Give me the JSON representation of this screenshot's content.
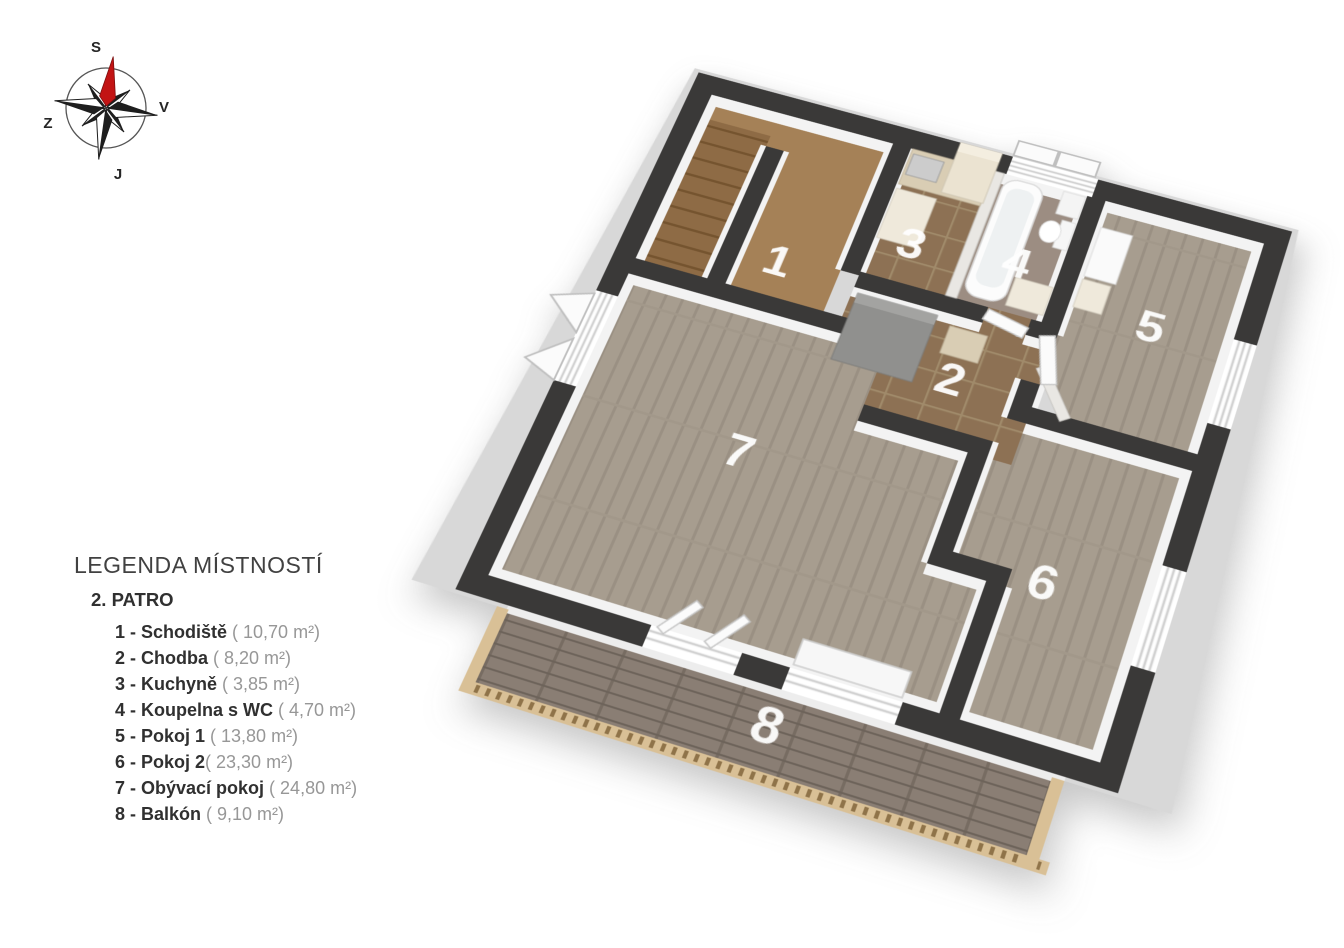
{
  "compass": {
    "north_label": "S",
    "east_label": "V",
    "south_label": "J",
    "west_label": "Z"
  },
  "legend": {
    "title": "LEGENDA MÍSTNOSTÍ",
    "floor": "2. PATRO",
    "items": [
      {
        "label": "1 - Schodiště",
        "area": " ( 10,70 m²)"
      },
      {
        "label": "2 - Chodba",
        "area": " ( 8,20 m²)"
      },
      {
        "label": "3 - Kuchyně",
        "area": " ( 3,85 m²)"
      },
      {
        "label": "4 - Koupelna s WC",
        "area": " ( 4,70 m²)"
      },
      {
        "label": "5 - Pokoj 1",
        "area": " ( 13,80 m²)"
      },
      {
        "label": "6 - Pokoj 2",
        "area": "( 23,30 m²)"
      },
      {
        "label": "7 - Obývací pokoj",
        "area": " ( 24,80 m²)"
      },
      {
        "label": "8 - Balkón",
        "area": " ( 9,10 m²)"
      }
    ]
  },
  "plan": {
    "rooms": [
      {
        "number": "1"
      },
      {
        "number": "2"
      },
      {
        "number": "3"
      },
      {
        "number": "4"
      },
      {
        "number": "5"
      },
      {
        "number": "6"
      },
      {
        "number": "7"
      },
      {
        "number": "8"
      }
    ]
  },
  "palette": {
    "wall": "#3a3938",
    "slab": "#d8d8d8",
    "stair_floor": "#a58157",
    "stair_steps": "#8e6b45",
    "tile_floor": "#8d7154",
    "tile_grout": "#a08a6a",
    "bath_floor": "#9c8d82",
    "wood_floor": "#a79d8f",
    "wood_plank_line": "#9a9083",
    "deck_floor": "#8a7e74",
    "railing": "#d9c096",
    "needle": "#c21414",
    "room_label": "#ffffff",
    "counter": "#d9cdb4",
    "cooktop": "#2e2b29"
  }
}
